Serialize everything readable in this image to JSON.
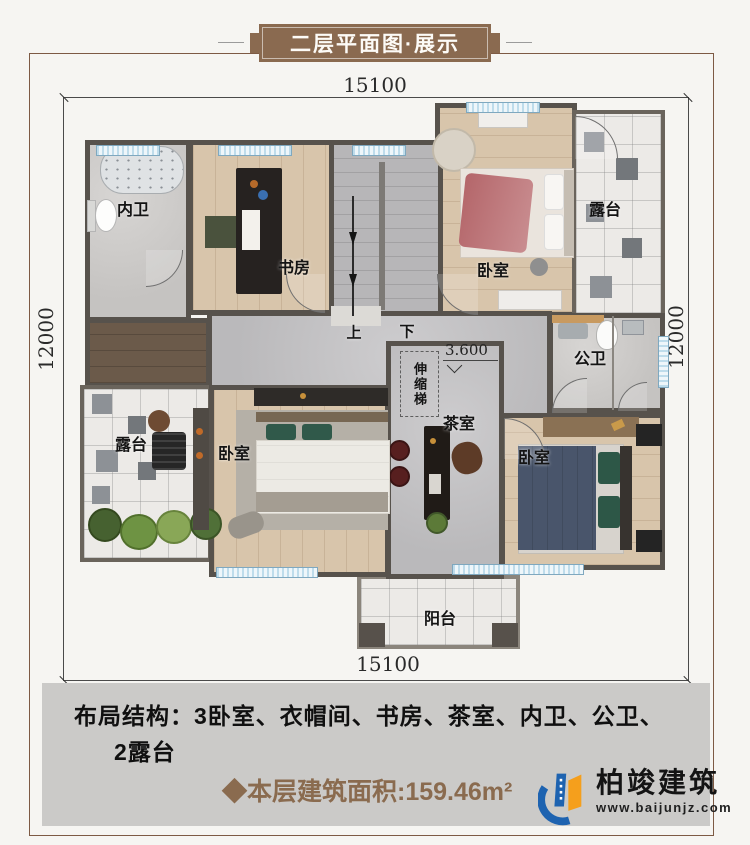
{
  "banner": {
    "title": "二层平面图·展示"
  },
  "dimensions": {
    "top": "15100",
    "bottom": "15100",
    "left": "12000",
    "right": "12000"
  },
  "plan": {
    "labels": {
      "bath_ensuite": "内卫",
      "study": "书房",
      "bedroom_top_right": "卧室",
      "terrace_top_right": "露台",
      "bathroom_public": "公卫",
      "terrace_bottom_left": "露台",
      "bedroom_bottom_left": "卧室",
      "tea_room": "茶室",
      "bedroom_bottom_right": "卧室",
      "balcony": "阳台",
      "retractable_ladder": "伸缩梯",
      "stairs_up": "上",
      "stairs_down": "下",
      "floor_level": "3.600"
    }
  },
  "footer": {
    "layout_line1": "布局结构：3卧室、衣帽间、书房、茶室、内卫、公卫、",
    "layout_line2": "2露台",
    "area_text": "◆本层建筑面积:159.46m²"
  },
  "logo": {
    "name": "柏竣建筑",
    "website": "www.baijunjz.com"
  },
  "colors": {
    "banner_bg": "#8a6a50",
    "frame_border": "#7d5a44",
    "wall": "#57524c",
    "window_blue": "#bedceb",
    "info_box_bg": "#cbcac8",
    "area_text": "#8a6b4f",
    "logo_blue": "#1e63b0",
    "logo_orange": "#f59f1c"
  }
}
